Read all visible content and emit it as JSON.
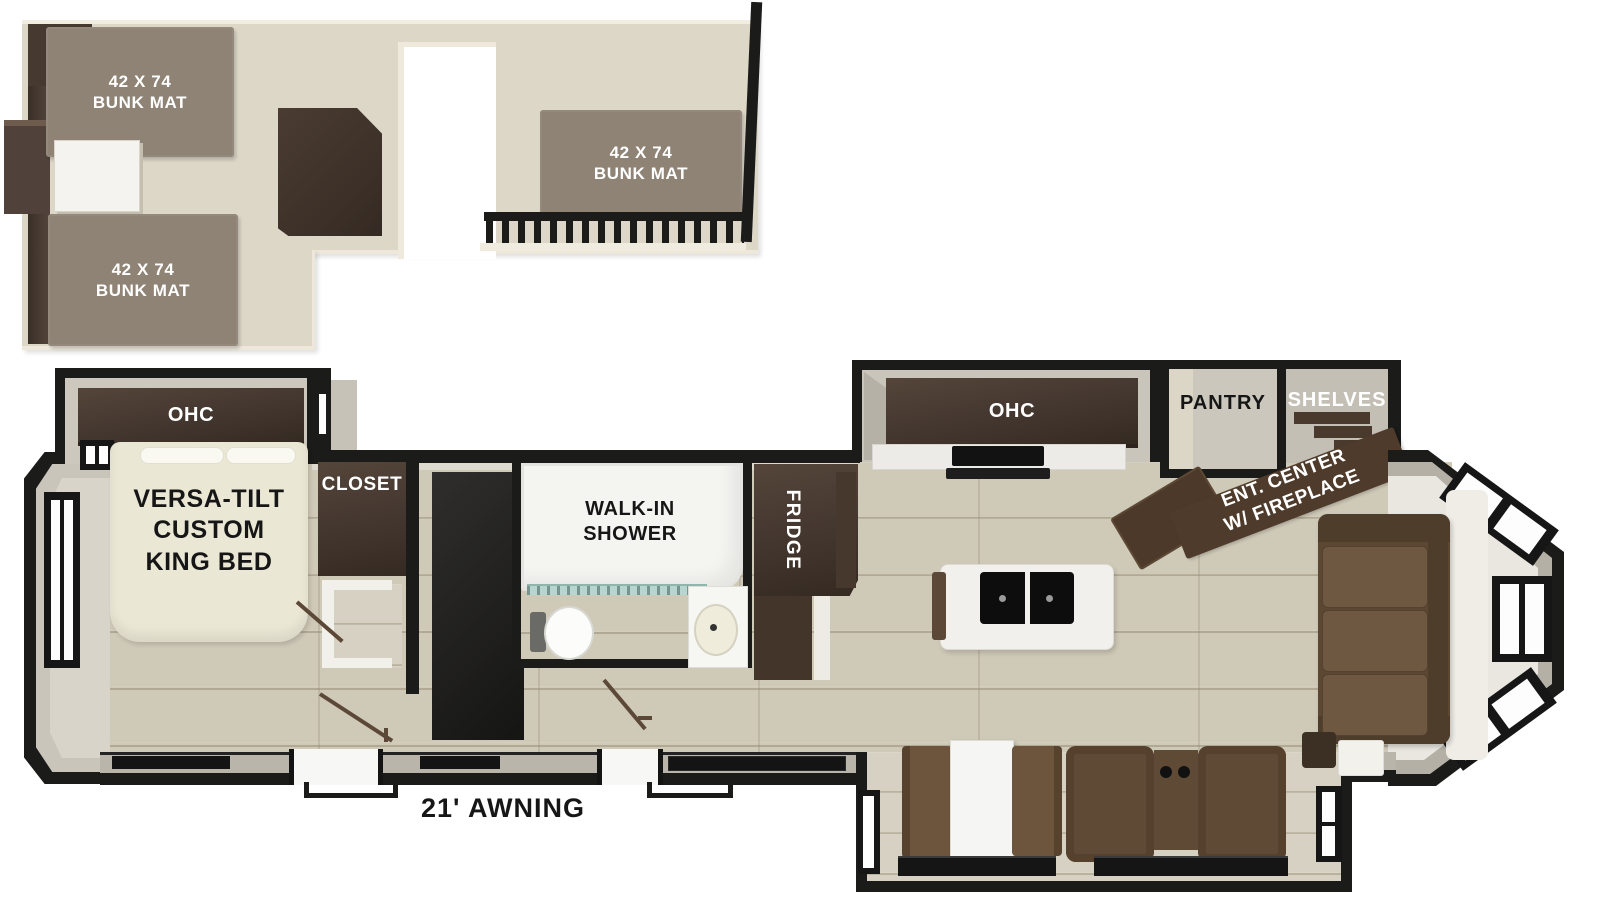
{
  "canvas": {
    "width": 1600,
    "height": 900,
    "background": "#ffffff"
  },
  "palette": {
    "wall_black": "#1b1b1a",
    "dark_wood_cabinet": "#46382c",
    "loft_floor": "#dcd7c7",
    "bunk_mat": "#8e8375",
    "plank_floor": "#cfc9b8",
    "bed_cream": "#ebe7d5",
    "sofa_brown": "#5f4a36",
    "counter_white": "#f1f0ec",
    "shower_glass": "#b7d6cf"
  },
  "loft": {
    "bunk_mat_label": "42 X 74\nBUNK MAT"
  },
  "bedroom": {
    "ohc_label": "OHC",
    "bed_label": "VERSA-TILT\nCUSTOM\nKING BED",
    "closet_label": "CLOSET"
  },
  "bathroom": {
    "shower_label": "WALK-IN\nSHOWER"
  },
  "kitchen": {
    "ohc_label": "OHC",
    "fridge_label": "FRIDGE",
    "pantry_label": "PANTRY",
    "shelves_label": "SHELVES"
  },
  "living": {
    "ent_center_label": "ENT. CENTER\nW/ FIREPLACE"
  },
  "exterior": {
    "awning_label": "21' AWNING"
  }
}
